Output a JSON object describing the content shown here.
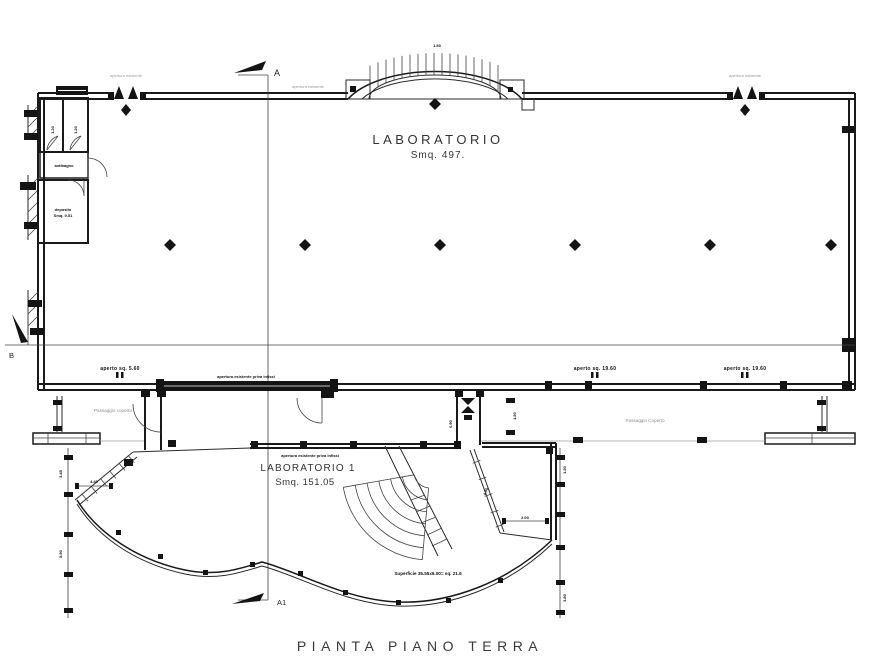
{
  "title": "PIANTA PIANO TERRA",
  "rooms": {
    "lab": {
      "name": "LABORATORIO",
      "area": "Smq. 497."
    },
    "lab1": {
      "name": "LABORATORIO 1",
      "area": "Smq. 151.05"
    }
  },
  "sections": {
    "top": "A",
    "bottom": "A1",
    "left": "B"
  },
  "passages": {
    "left": "Passaggio coperto",
    "right": "Passaggio Coperto"
  },
  "openings": {
    "left": "aperto sq. 5.60",
    "mid": "aperto sq. 19.60",
    "right": "aperto sq. 19.60"
  },
  "notes": {
    "window_left": "apertura esistente",
    "window_right": "apertura esistente",
    "arch_left": "apertura esistente",
    "band": "apertura esistente priva infissi",
    "wing_top": "apertura esistente priva infissi",
    "surface": "Superficie 35.55x6.00= sq. 21.6"
  },
  "small_rooms": {
    "stall_a": "1.20",
    "stall_b": "1.20",
    "lobby": "antibagno",
    "store": "deposito",
    "store_area": "Smq. 9.51"
  },
  "dims": {
    "arch": "1.50",
    "passage": "1.50",
    "corner": "2.00",
    "wing_left": "4.40",
    "corridor": "0.90",
    "left_chain_a": "3.45",
    "left_chain_b": "5.90",
    "right_chain_a": "1.50",
    "right_chain_b": "3.80",
    "angled": "4.95"
  },
  "colors": {
    "ink": "#1a1a1a",
    "gray": "#8d8d8d",
    "bg": "#ffffff"
  }
}
